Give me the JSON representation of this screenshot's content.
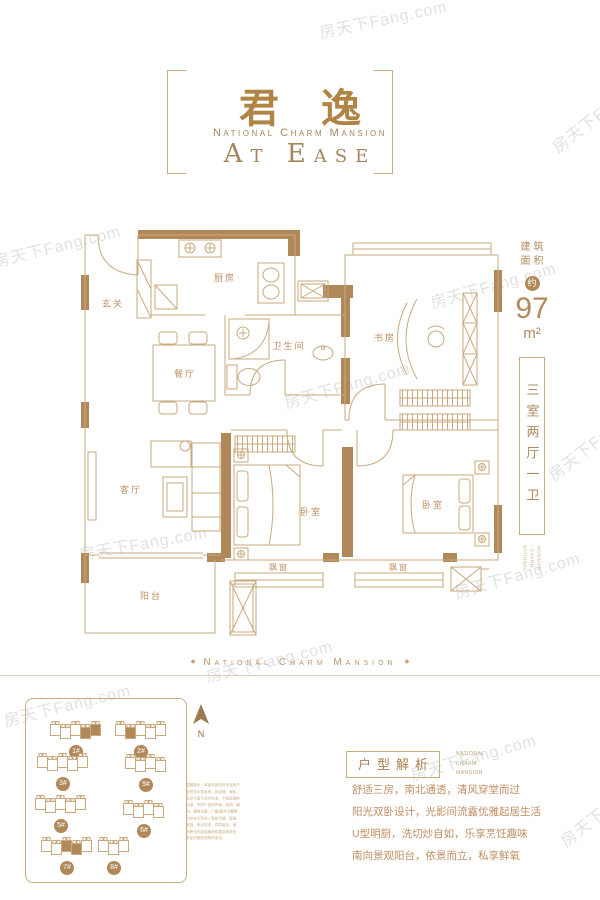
{
  "watermark": {
    "text": "房天下Fang.com"
  },
  "header": {
    "title_cn": "君逸",
    "subtitle_en": "National Charm Mansion",
    "tagline": "At Ease"
  },
  "floorplan": {
    "rooms": {
      "entry": "玄关",
      "kitchen": "厨房",
      "dining": "餐厅",
      "bathroom": "卫生间",
      "study": "书房",
      "living": "客厅",
      "bedroom1": "卧室",
      "bedroom2": "卧室",
      "balcony": "阳台",
      "bay_window": "飘窗"
    }
  },
  "spec": {
    "area_label_top": "建筑",
    "area_label_bottom": "面积",
    "approx_badge": "约",
    "area_value": "97",
    "area_unit": "m²",
    "layout_text": "三室两厅一卫",
    "brand_words": [
      "National",
      "Charm",
      "Mansion"
    ]
  },
  "divider": {
    "text": "National Charm Mansion",
    "ornament": "◆"
  },
  "siteplan": {
    "north_label": "N",
    "buildings": [
      {
        "label": "1#",
        "x": 50,
        "y": 22,
        "units": 5,
        "filled": [
          3,
          4
        ]
      },
      {
        "label": "2#",
        "x": 115,
        "y": 22,
        "units": 5,
        "filled": [
          1
        ]
      },
      {
        "label": "3#",
        "x": 37,
        "y": 54,
        "units": 5,
        "filled": []
      },
      {
        "label": "9#",
        "x": 120,
        "y": 55,
        "units": 4,
        "filled": []
      },
      {
        "label": "5#",
        "x": 35,
        "y": 96,
        "units": 5,
        "filled": []
      },
      {
        "label": "6#",
        "x": 118,
        "y": 101,
        "units": 4,
        "filled": []
      },
      {
        "label": "7#",
        "x": 41,
        "y": 138,
        "units": 5,
        "filled": [
          2,
          3
        ]
      },
      {
        "label": "8#",
        "x": 88,
        "y": 138,
        "units": 3,
        "filled": []
      }
    ],
    "disclaimer_lines": [
      "温馨提示：本宣传资料所涉及的户",
      "型仅供示意参考，其设施、家私、",
      "陈设不属于交付标准，不同房源的",
      "标准、不同户型的布局、结构、朝",
      "向、管线位置、门窗/管井位置等",
      "均存在不完全一致的可能，层高、",
      "报批、单元构成、同层组合、面",
      "积等也可能因楼栋和楼层审批的",
      "审定的差别而有所变化。"
    ]
  },
  "analysis": {
    "box_title": "户型解析",
    "brand_lines": [
      "National",
      "Charm",
      "Mansion"
    ],
    "paragraphs": [
      "舒适三房，南北通透，清风穿堂而过",
      "阳光双卧设计，光影间流露优雅起居生活",
      "U型明厨，洗切炒自如，乐享烹饪趣味",
      "南向景观阳台，依景而立，私享鲜氧"
    ]
  }
}
